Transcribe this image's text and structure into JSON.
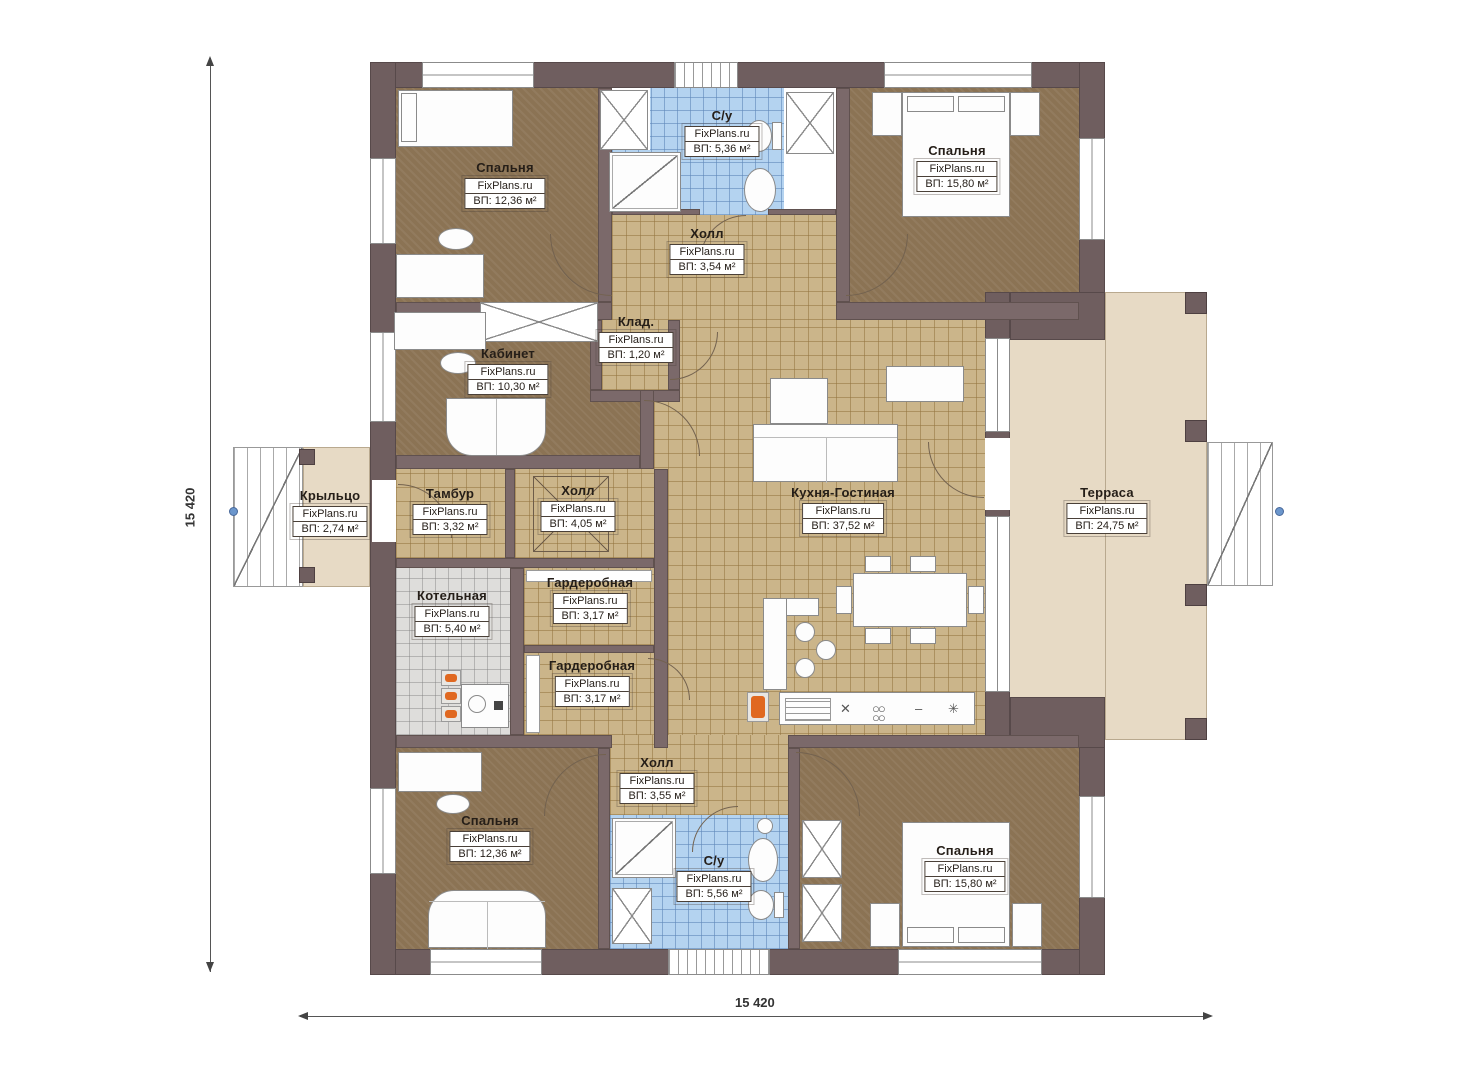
{
  "watermark": "FixPlans.ru",
  "dimensions": {
    "vertical": "15 420",
    "horizontal": "15 420"
  },
  "rooms": [
    {
      "id": "bedroom-top-left",
      "name": "Спальня",
      "watermark": "FixPlans.ru",
      "area": "ВП: 12,36 м²"
    },
    {
      "id": "bathroom-top",
      "name": "С/у",
      "watermark": "FixPlans.ru",
      "area": "ВП: 5,36 м²"
    },
    {
      "id": "bedroom-top-right",
      "name": "Спальня",
      "watermark": "FixPlans.ru",
      "area": "ВП: 15,80 м²"
    },
    {
      "id": "hall-top",
      "name": "Холл",
      "watermark": "FixPlans.ru",
      "area": "ВП: 3,54 м²"
    },
    {
      "id": "storage",
      "name": "Клад.",
      "watermark": "FixPlans.ru",
      "area": "ВП: 1,20 м²"
    },
    {
      "id": "office",
      "name": "Кабинет",
      "watermark": "FixPlans.ru",
      "area": "ВП: 10,30 м²"
    },
    {
      "id": "porch",
      "name": "Крыльцо",
      "watermark": "FixPlans.ru",
      "area": "ВП: 2,74 м²"
    },
    {
      "id": "vestibule",
      "name": "Тамбур",
      "watermark": "FixPlans.ru",
      "area": "ВП: 3,32 м²"
    },
    {
      "id": "hall-middle",
      "name": "Холл",
      "watermark": "FixPlans.ru",
      "area": "ВП: 4,05 м²"
    },
    {
      "id": "kitchen-living",
      "name": "Кухня-Гостиная",
      "watermark": "FixPlans.ru",
      "area": "ВП: 37,52 м²"
    },
    {
      "id": "terrace",
      "name": "Терраса",
      "watermark": "FixPlans.ru",
      "area": "ВП: 24,75 м²"
    },
    {
      "id": "boiler-room",
      "name": "Котельная",
      "watermark": "FixPlans.ru",
      "area": "ВП: 5,40 м²"
    },
    {
      "id": "wardrobe-upper",
      "name": "Гардеробная",
      "watermark": "FixPlans.ru",
      "area": "ВП: 3,17 м²"
    },
    {
      "id": "wardrobe-lower",
      "name": "Гардеробная",
      "watermark": "FixPlans.ru",
      "area": "ВП: 3,17 м²"
    },
    {
      "id": "hall-bottom",
      "name": "Холл",
      "watermark": "FixPlans.ru",
      "area": "ВП: 3,55 м²"
    },
    {
      "id": "bathroom-bottom",
      "name": "С/у",
      "watermark": "FixPlans.ru",
      "area": "ВП: 5,56 м²"
    },
    {
      "id": "bedroom-bottom-left",
      "name": "Спальня",
      "watermark": "FixPlans.ru",
      "area": "ВП: 12,36 м²"
    },
    {
      "id": "bedroom-bottom-right",
      "name": "Спальня",
      "watermark": "FixPlans.ru",
      "area": "ВП: 15,80 м²"
    }
  ],
  "colors": {
    "wall": "#6f5e5f",
    "floor_wood": "#8b7354",
    "floor_tile_tan": "#cbb58a",
    "floor_tile_blue": "#b4d3f0",
    "floor_tile_gray": "#dedddb",
    "terrace": "#e7dac5",
    "accent_orange": "#e06820",
    "marker_blue": "#6b96cc"
  }
}
